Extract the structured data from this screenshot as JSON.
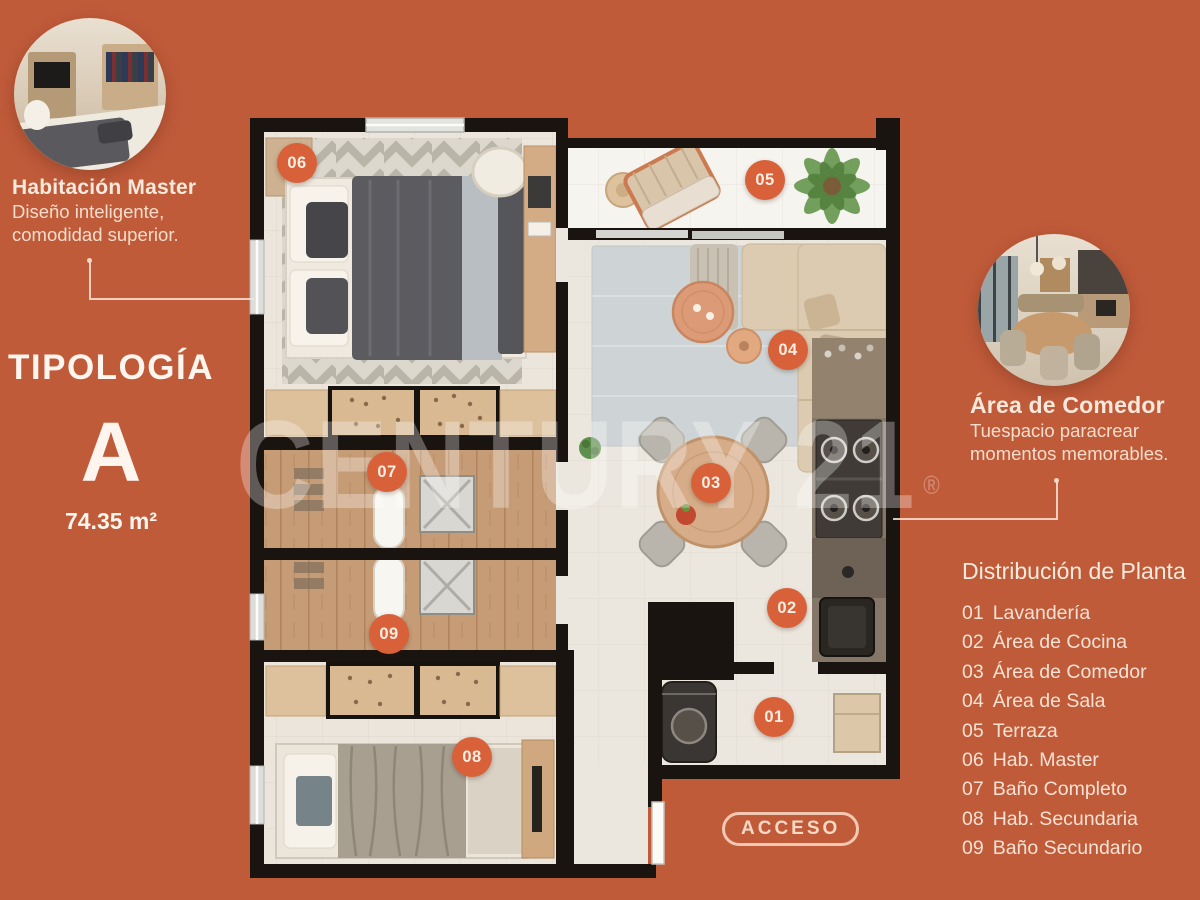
{
  "colors": {
    "background": "#c05b3a",
    "badge": "#d8613a",
    "wall": "#1a1410",
    "text": "#f6e2d4"
  },
  "callout_master": {
    "title": "Habitación Master",
    "line1": "Diseño inteligente,",
    "line2": "comodidad superior."
  },
  "callout_dining": {
    "title": "Área de Comedor",
    "line1": "Tuespacio paracrear",
    "line2": "momentos memorables."
  },
  "typology": {
    "label": "TIPOLOGÍA",
    "letter": "A",
    "area": "74.35 m²"
  },
  "legend": {
    "title": "Distribución de Planta",
    "items": [
      {
        "num": "01",
        "label": "Lavandería"
      },
      {
        "num": "02",
        "label": "Área de Cocina"
      },
      {
        "num": "03",
        "label": "Área de Comedor"
      },
      {
        "num": "04",
        "label": "Área de Sala"
      },
      {
        "num": "05",
        "label": "Terraza"
      },
      {
        "num": "06",
        "label": "Hab. Master"
      },
      {
        "num": "07",
        "label": "Baño Completo"
      },
      {
        "num": "08",
        "label": "Hab. Secundaria"
      },
      {
        "num": "09",
        "label": "Baño Secundario"
      }
    ]
  },
  "plan_badges": {
    "b01": "01",
    "b02": "02",
    "b03": "03",
    "b04": "04",
    "b05": "05",
    "b06": "06",
    "b07": "07",
    "b08": "08",
    "b09": "09"
  },
  "access": {
    "label": "ACCESO"
  },
  "watermark": {
    "text": "CENTURY 21",
    "reg": "®"
  }
}
